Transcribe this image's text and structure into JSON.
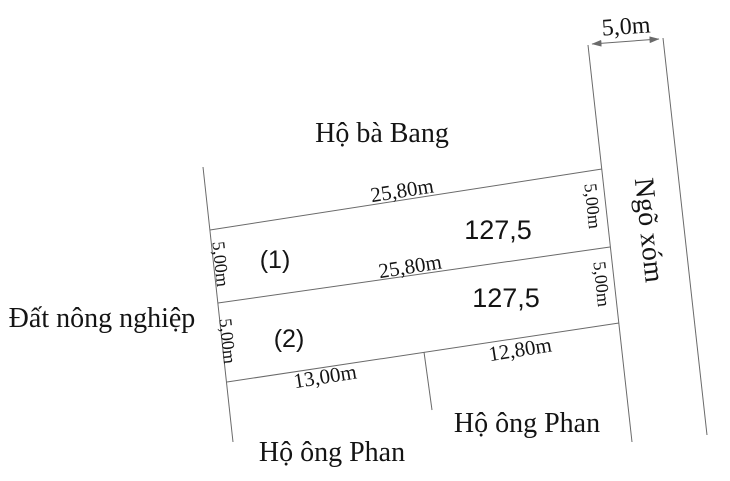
{
  "title": "Land plot sketch",
  "colors": {
    "background": "#ffffff",
    "line": "#6a6a6a",
    "text": "#141414"
  },
  "road": {
    "name": "Ngõ xóm",
    "width": "5,0m"
  },
  "neighbors": {
    "top": "Hộ bà Bang",
    "left": "Đất nông nghiệp",
    "bottom_left": "Hộ ông Phan",
    "bottom_right": "Hộ ông Phan"
  },
  "plots": [
    {
      "id": "(1)",
      "area": "127,5",
      "front": "25,80m",
      "side_left": "5,00m",
      "side_right": "5,00m"
    },
    {
      "id": "(2)",
      "area": "127,5",
      "front": "25,80m",
      "side_left": "5,00m",
      "side_right": "5,00m"
    }
  ],
  "bottom_dimensions": {
    "left": "13,00m",
    "right": "12,80m"
  }
}
